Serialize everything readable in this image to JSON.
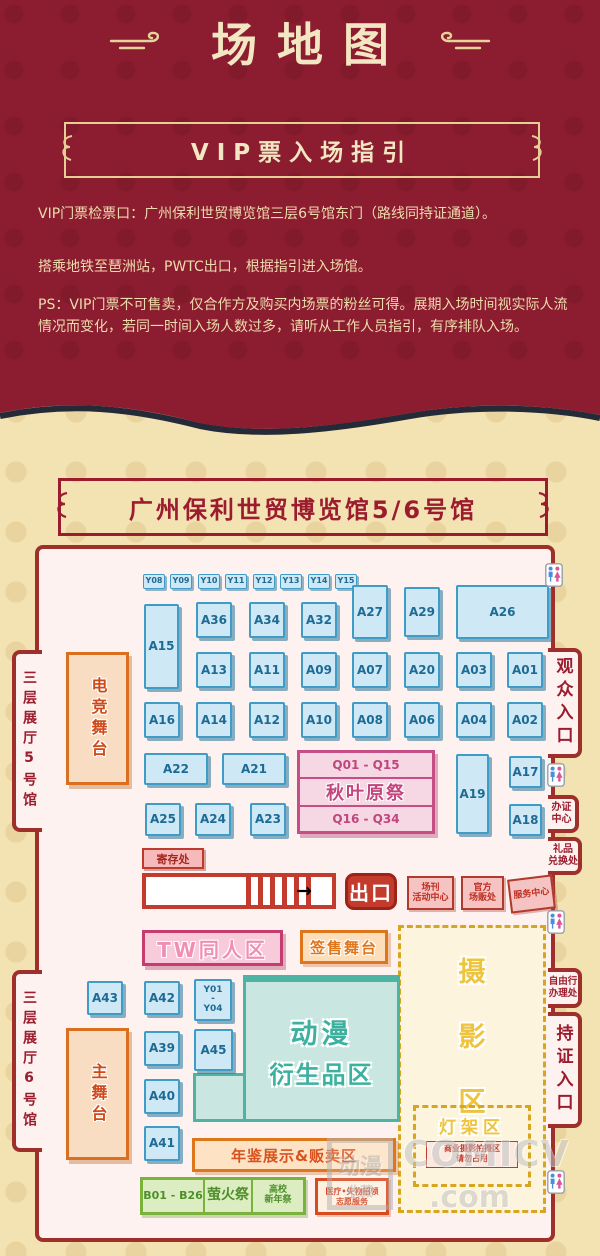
{
  "page": {
    "title": "场地图",
    "colors": {
      "top_bg": "#8c1c2f",
      "bottom_bg": "#f3e2b2",
      "gold": "#e8d49a",
      "dark_red": "#9b1c2e",
      "booth_blue": "#cfe8f5"
    }
  },
  "vip": {
    "title": "VIP票入场指引",
    "paragraphs": [
      "VIP门票检票口：广州保利世贸博览馆三层6号馆东门（路线同持证通道）。",
      "搭乘地铁至琶洲站，PWTC出口，根据指引进入场馆。",
      "PS：VIP门票不可售卖，仅合作方及购买内场票的粉丝可得。展期入场时间视实际人流情况而变化，若同一时间入场人数过多，请听从工作人员指引，有序排队入场。"
    ]
  },
  "venue": {
    "title": "广州保利世贸博览馆5/6号馆"
  },
  "map": {
    "hall5_tab": "三层展厅5号馆",
    "hall6_tab": "三层展厅6号馆",
    "right_tabs": {
      "audience": "观众入口",
      "cert1": "办证",
      "cert2": "中心",
      "gift1": "礼品",
      "gift2": "兑换处",
      "free1": "自由行",
      "free2": "办理处",
      "pass": "持证入口"
    },
    "stages": {
      "esports": "电竞舞台",
      "main": "主舞台",
      "signing": "签售舞台"
    },
    "akiba": {
      "top": "Q01 - Q15",
      "title": "秋叶原祭",
      "bottom": "Q16 - Q34"
    },
    "locker": "寄存处",
    "exit": "出口",
    "services": [
      {
        "line1": "场刊",
        "line2": "活动中心"
      },
      {
        "line1": "官方",
        "line2": "场贩处"
      },
      {
        "line1": "服务中心",
        "line2": ""
      }
    ],
    "tw_zone": "TW同人区",
    "merch": {
      "line1": "动漫",
      "line2": "衍生品区"
    },
    "yearbook": "年鉴展示&贩卖区",
    "photo": {
      "chars": [
        "摄",
        "影",
        "区"
      ]
    },
    "rack": {
      "label": "灯架区",
      "note1": "商业摄影拍摄区",
      "note2": "请勿占用"
    },
    "b_row": {
      "range": "B01 - B26",
      "firefly": "萤火祭",
      "school1": "高校",
      "school2": "新年祭"
    },
    "aid": {
      "line1": "医疗•失物招领",
      "line2": "志愿服务"
    },
    "booths": [
      {
        "label": "Y08",
        "x": 104,
        "y": 25,
        "w": 22,
        "h": 15,
        "cls": "ytag"
      },
      {
        "label": "Y09",
        "x": 131,
        "y": 25,
        "w": 22,
        "h": 15,
        "cls": "ytag"
      },
      {
        "label": "Y10",
        "x": 159,
        "y": 25,
        "w": 22,
        "h": 15,
        "cls": "ytag"
      },
      {
        "label": "Y11",
        "x": 186,
        "y": 25,
        "w": 22,
        "h": 15,
        "cls": "ytag"
      },
      {
        "label": "Y12",
        "x": 214,
        "y": 25,
        "w": 22,
        "h": 15,
        "cls": "ytag"
      },
      {
        "label": "Y13",
        "x": 241,
        "y": 25,
        "w": 22,
        "h": 15,
        "cls": "ytag"
      },
      {
        "label": "Y14",
        "x": 269,
        "y": 25,
        "w": 22,
        "h": 15,
        "cls": "ytag"
      },
      {
        "label": "Y15",
        "x": 296,
        "y": 25,
        "w": 22,
        "h": 15,
        "cls": "ytag"
      },
      {
        "label": "A15",
        "x": 105,
        "y": 55,
        "w": 35,
        "h": 85
      },
      {
        "label": "A36",
        "x": 157,
        "y": 53,
        "w": 36,
        "h": 36
      },
      {
        "label": "A34",
        "x": 210,
        "y": 53,
        "w": 36,
        "h": 36
      },
      {
        "label": "A32",
        "x": 262,
        "y": 53,
        "w": 36,
        "h": 36
      },
      {
        "label": "A27",
        "x": 313,
        "y": 36,
        "w": 36,
        "h": 54
      },
      {
        "label": "A29",
        "x": 365,
        "y": 38,
        "w": 36,
        "h": 50
      },
      {
        "label": "A26",
        "x": 417,
        "y": 36,
        "w": 93,
        "h": 54
      },
      {
        "label": "A13",
        "x": 157,
        "y": 103,
        "w": 36,
        "h": 36
      },
      {
        "label": "A11",
        "x": 210,
        "y": 103,
        "w": 36,
        "h": 36
      },
      {
        "label": "A09",
        "x": 262,
        "y": 103,
        "w": 36,
        "h": 36
      },
      {
        "label": "A07",
        "x": 313,
        "y": 103,
        "w": 36,
        "h": 36
      },
      {
        "label": "A20",
        "x": 365,
        "y": 103,
        "w": 36,
        "h": 36
      },
      {
        "label": "A03",
        "x": 417,
        "y": 103,
        "w": 36,
        "h": 36
      },
      {
        "label": "A01",
        "x": 468,
        "y": 103,
        "w": 36,
        "h": 36
      },
      {
        "label": "A16",
        "x": 105,
        "y": 153,
        "w": 36,
        "h": 36
      },
      {
        "label": "A14",
        "x": 157,
        "y": 153,
        "w": 36,
        "h": 36
      },
      {
        "label": "A12",
        "x": 210,
        "y": 153,
        "w": 36,
        "h": 36
      },
      {
        "label": "A10",
        "x": 262,
        "y": 153,
        "w": 36,
        "h": 36
      },
      {
        "label": "A08",
        "x": 313,
        "y": 153,
        "w": 36,
        "h": 36
      },
      {
        "label": "A06",
        "x": 365,
        "y": 153,
        "w": 36,
        "h": 36
      },
      {
        "label": "A04",
        "x": 417,
        "y": 153,
        "w": 36,
        "h": 36
      },
      {
        "label": "A02",
        "x": 468,
        "y": 153,
        "w": 36,
        "h": 36
      },
      {
        "label": "A22",
        "x": 105,
        "y": 204,
        "w": 64,
        "h": 32
      },
      {
        "label": "A21",
        "x": 183,
        "y": 204,
        "w": 64,
        "h": 32
      },
      {
        "label": "A19",
        "x": 417,
        "y": 205,
        "w": 33,
        "h": 80
      },
      {
        "label": "A17",
        "x": 470,
        "y": 207,
        "w": 33,
        "h": 32
      },
      {
        "label": "A18",
        "x": 470,
        "y": 255,
        "w": 33,
        "h": 32
      },
      {
        "label": "A25",
        "x": 106,
        "y": 254,
        "w": 36,
        "h": 33
      },
      {
        "label": "A24",
        "x": 156,
        "y": 254,
        "w": 36,
        "h": 33
      },
      {
        "label": "A23",
        "x": 211,
        "y": 254,
        "w": 36,
        "h": 33
      },
      {
        "label": "A43",
        "x": 48,
        "y": 432,
        "w": 36,
        "h": 34
      },
      {
        "label": "A42",
        "x": 105,
        "y": 432,
        "w": 36,
        "h": 34
      },
      {
        "label": "Y01-Y04",
        "lines": [
          "Y01",
          "-",
          "Y04"
        ],
        "x": 155,
        "y": 430,
        "w": 38,
        "h": 42,
        "cls": "multiline"
      },
      {
        "label": "A39",
        "x": 105,
        "y": 482,
        "w": 36,
        "h": 35
      },
      {
        "label": "A45",
        "x": 155,
        "y": 480,
        "w": 39,
        "h": 42
      },
      {
        "label": "A40",
        "x": 105,
        "y": 530,
        "w": 36,
        "h": 35
      },
      {
        "label": "A41",
        "x": 105,
        "y": 577,
        "w": 36,
        "h": 35
      }
    ],
    "restrooms": [
      {
        "x": 506,
        "y": 14
      },
      {
        "x": 508,
        "y": 214
      },
      {
        "x": 508,
        "y": 361
      },
      {
        "x": 508,
        "y": 621
      }
    ]
  },
  "watermark": {
    "logo1": "动漫",
    "logo2": "收藏",
    "brand": "COMICV",
    "suffix": ".com"
  }
}
